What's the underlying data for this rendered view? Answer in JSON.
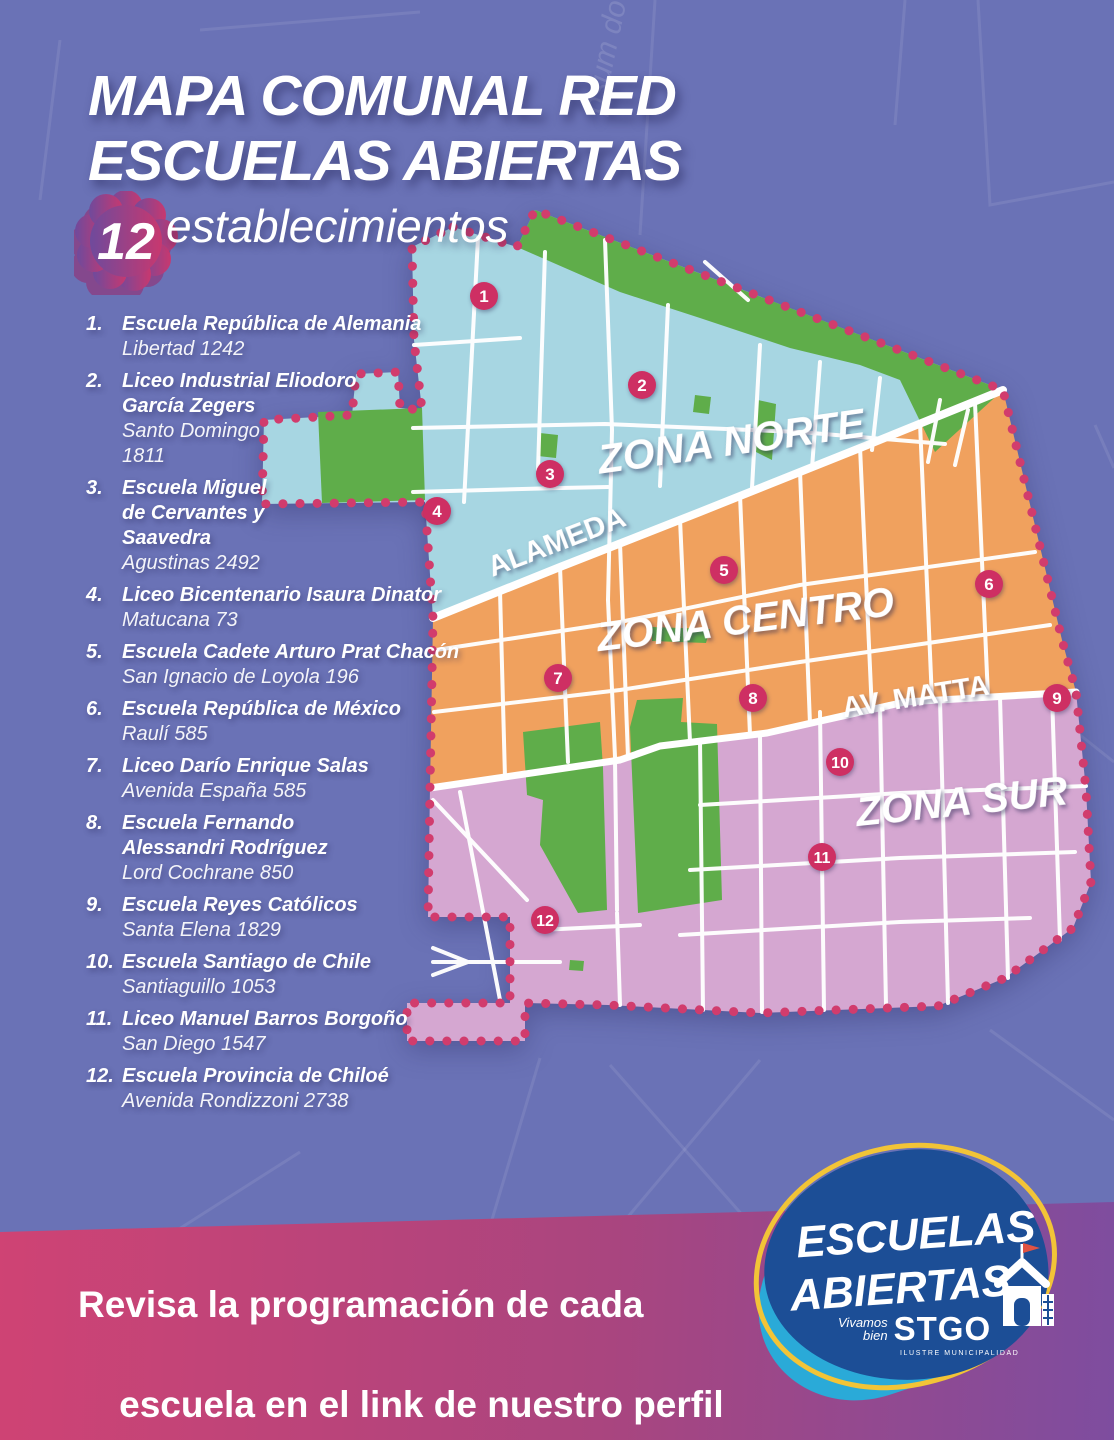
{
  "page": {
    "title_line1": "MAPA COMUNAL RED",
    "title_line2": "ESCUELAS ABIERTAS",
    "count_badge": "12",
    "count_label": "establecimientos",
    "watermark": "psum do"
  },
  "schools": [
    {
      "num": "1.",
      "name": "Escuela República de Alemania",
      "address": "Libertad 1242"
    },
    {
      "num": "2.",
      "name": "Liceo Industrial Eliodoro\nGarcía Zegers",
      "address": "Santo Domingo\n1811"
    },
    {
      "num": "3.",
      "name": "Escuela Miguel\nde Cervantes y\nSaavedra",
      "address": "Agustinas 2492"
    },
    {
      "num": "4.",
      "name": "Liceo Bicentenario Isaura Dinator",
      "address": "Matucana 73"
    },
    {
      "num": "5.",
      "name": "Escuela Cadete Arturo Prat Chacón",
      "address": "San Ignacio de Loyola 196"
    },
    {
      "num": "6.",
      "name": "Escuela República de México",
      "address": "Raulí 585"
    },
    {
      "num": "7.",
      "name": "Liceo Darío Enrique Salas",
      "address": "Avenida España 585"
    },
    {
      "num": "8.",
      "name": "Escuela Fernando\nAlessandri Rodríguez",
      "address": "Lord Cochrane 850"
    },
    {
      "num": "9.",
      "name": "Escuela Reyes Católicos",
      "address": "Santa Elena 1829"
    },
    {
      "num": "10.",
      "name": "Escuela Santiago de Chile",
      "address": "Santiaguillo 1053"
    },
    {
      "num": "11.",
      "name": "Liceo Manuel Barros Borgoño",
      "address": "San Diego 1547"
    },
    {
      "num": "12.",
      "name": "Escuela Provincia de Chiloé",
      "address": "Avenida Rondizzoni 2738"
    }
  ],
  "map": {
    "zone_norte_label": "ZONA NORTE",
    "zone_centro_label": "ZONA CENTRO",
    "zone_sur_label": "ZONA SUR",
    "street_alameda_label": "ALAMEDA",
    "street_matta_label": "AV. MATTA",
    "markers": [
      "1",
      "2",
      "3",
      "4",
      "5",
      "6",
      "7",
      "8",
      "9",
      "10",
      "11",
      "12"
    ],
    "colors": {
      "zone_norte": "#a7d6e2",
      "zone_centro": "#f0a15e",
      "zone_sur": "#d5a7d1",
      "park_green": "#5fad4a",
      "border_dots": "#d13c6d",
      "marker": "#ce2f63",
      "street": "#ffffff",
      "background": "#6a72b6",
      "footer_left": "#cf4374",
      "footer_right": "#7e4d9f",
      "logo_dark_blue": "#1c4e96",
      "logo_light_blue": "#2aaad8",
      "logo_yellow": "#f2c437",
      "flag_red": "#e05343",
      "flower_purple": "#6f4a9c",
      "flower_pink": "#c8386f"
    }
  },
  "footer": {
    "message_line1": "Revisa la programación de cada",
    "message_line2": "escuela en el link de nuestro perfil"
  },
  "logo": {
    "line1": "ESCUELAS",
    "line2": "ABIERTAS",
    "tagline_top": "Vivamos",
    "tagline_bottom": "bien",
    "brand": "STGO",
    "sub_brand": "ILUSTRE MUNICIPALIDAD"
  }
}
